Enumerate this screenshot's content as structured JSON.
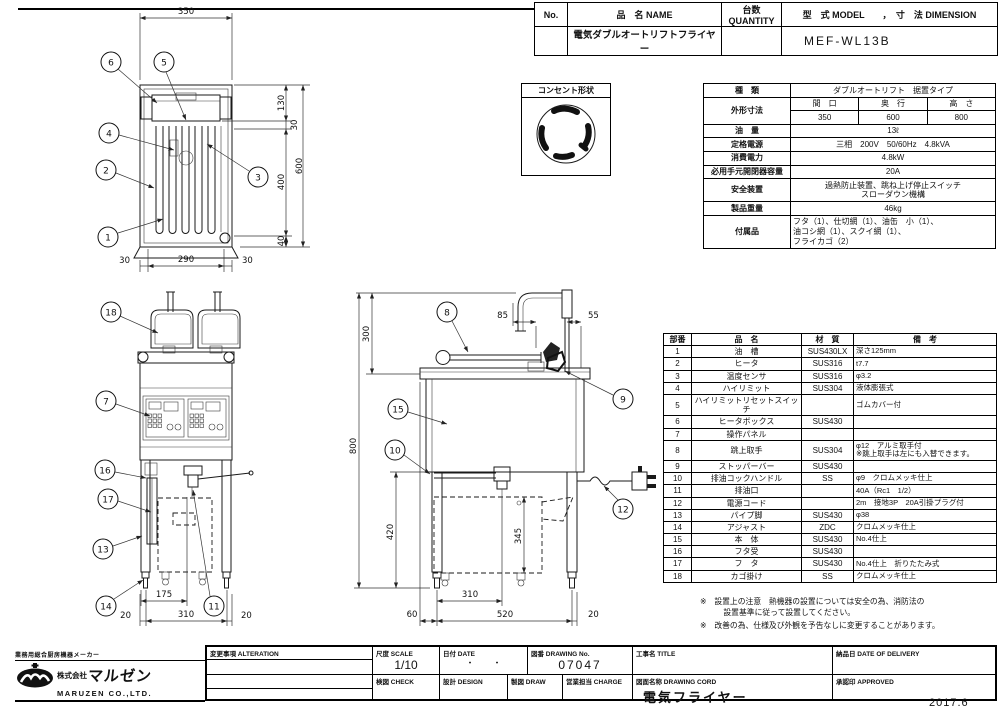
{
  "header": {
    "no_label": "No.",
    "name_label": "品　名 NAME",
    "qty_label": "台数 QUANTITY",
    "model_dim_label": "型　式 MODEL　　，　寸　法 DIMENSION",
    "product_name": "電気ダブルオートリフトフライヤー",
    "model_value": "MEF-WL13B"
  },
  "outlet": {
    "label": "コンセント形状"
  },
  "spec": {
    "kind_label": "種　類",
    "kind_value": "ダブルオートリフト　据置タイプ",
    "outer_dims_label": "外形寸法",
    "dim_cols": [
      {
        "h": "間　口",
        "v": "350"
      },
      {
        "h": "奥　行",
        "v": "600"
      },
      {
        "h": "高　さ",
        "v": "800"
      }
    ],
    "oil_label": "油　量",
    "oil_value": "13ℓ",
    "power_label": "定格電源",
    "power_value": "三相　200V　50/60Hz　4.8kVA",
    "consumption_label": "消費電力",
    "consumption_value": "4.8kW",
    "breaker_label": "必用手元開閉器容量",
    "breaker_value": "20A",
    "safety_label": "安全装置",
    "safety_value": "過熱防止装置、跳ね上げ停止スイッチ\nスローダウン機構",
    "weight_label": "製品重量",
    "weight_value": "46kg",
    "accessories_label": "付属品",
    "accessories_value": "フタ（1）、仕切網（1）、油缶　小（1）、\n油コシ網（1）、スクイ網（1）、\nフライカゴ（2）"
  },
  "parts": {
    "headers": [
      "部番",
      "品　名",
      "材　質",
      "備　考"
    ],
    "rows": [
      {
        "no": "1",
        "name": "油　槽",
        "material": "SUS430LX",
        "note": "深さ125mm"
      },
      {
        "no": "2",
        "name": "ヒータ",
        "material": "SUS316",
        "note": "t7.7"
      },
      {
        "no": "3",
        "name": "温度センサ",
        "material": "SUS316",
        "note": "φ3.2"
      },
      {
        "no": "4",
        "name": "ハイリミット",
        "material": "SUS304",
        "note": "液体膨張式"
      },
      {
        "no": "5",
        "name": "ハイリミットリセットスイッチ",
        "material": "",
        "note": "ゴムカバー付"
      },
      {
        "no": "6",
        "name": "ヒータボックス",
        "material": "SUS430",
        "note": ""
      },
      {
        "no": "7",
        "name": "操作パネル",
        "material": "",
        "note": ""
      },
      {
        "no": "8",
        "name": "跳上取手",
        "material": "SUS304",
        "note": "φ12　アルミ取手付\n※跳上取手は左にも入替できます。"
      },
      {
        "no": "9",
        "name": "ストッパーバー",
        "material": "SUS430",
        "note": ""
      },
      {
        "no": "10",
        "name": "排油コックハンドル",
        "material": "SS",
        "note": "φ9　クロムメッキ仕上"
      },
      {
        "no": "11",
        "name": "排油口",
        "material": "",
        "note": "40A（Rc1　1/2）"
      },
      {
        "no": "12",
        "name": "電源コード",
        "material": "",
        "note": "2m　接地3P　20A引掛プラグ付"
      },
      {
        "no": "13",
        "name": "パイプ脚",
        "material": "SUS430",
        "note": "φ38"
      },
      {
        "no": "14",
        "name": "アジャスト",
        "material": "ZDC",
        "note": "クロムメッキ仕上"
      },
      {
        "no": "15",
        "name": "本　体",
        "material": "SUS430",
        "note": "No.4仕上"
      },
      {
        "no": "16",
        "name": "フタ受",
        "material": "SUS430",
        "note": ""
      },
      {
        "no": "17",
        "name": "フ　タ",
        "material": "SUS430",
        "note": "No.4仕上　折りたたみ式"
      },
      {
        "no": "18",
        "name": "カゴ掛け",
        "material": "SS",
        "note": "クロムメッキ仕上"
      }
    ]
  },
  "notes": {
    "note1": "※　設置上の注意　熱機器の設置については安全の為、消防法の\n　　　設置基準に従って設置してください。",
    "note2": "※　改善の為、仕様及び外観を予告なしに変更することがあります。"
  },
  "title_block": {
    "alteration": "変更事項  ALTERATION",
    "scale_label": "尺度  SCALE",
    "scale_value": "1/10",
    "date_label": "日付  DATE",
    "date_value": "・　　・",
    "dwg_no_label": "図番  DRAWING No.",
    "dwg_no_value": "07047",
    "title_label": "工事名  TITLE",
    "delivery_label": "納品日  DATE OF DELIVERY",
    "check_label": "検図  CHECK",
    "design_label": "設計  DESIGN",
    "draw_label": "製図  DRAW",
    "charge_label": "営業担当  CHARGE",
    "dwg_name_label": "図面名称  DRAWING CORD",
    "dwg_name_value": "電気フライヤー",
    "approved_label": "承認印  APPROVED"
  },
  "logo": {
    "tagline": "業務用総合厨房機器メーカー",
    "company_prefix": "株式会社",
    "company_name": "マルゼン",
    "company_en": "MARUZEN  CO.,LTD."
  },
  "issue_date": "2017.6",
  "drawings": {
    "plan": {
      "dim_width": "350",
      "seg_130": "130",
      "seg_30t": "30",
      "seg_400": "400",
      "seg_40": "40",
      "dim_total": "600",
      "bottom": [
        "30",
        "290",
        "30"
      ],
      "callouts": [
        "6",
        "5",
        "4",
        "2",
        "3",
        "1"
      ]
    },
    "front": {
      "dim_175": "175",
      "bottom": [
        "20",
        "310",
        "20"
      ],
      "callouts": [
        "18",
        "7",
        "16",
        "17",
        "13",
        "14",
        "11"
      ]
    },
    "side": {
      "dim_300": "300",
      "dim_85": "85",
      "dim_55": "55",
      "dim_800": "800",
      "dim_420": "420",
      "dim_345": "345",
      "dim_310": "310",
      "bottom": [
        "60",
        "520",
        "20"
      ],
      "callouts": [
        "8",
        "9",
        "15",
        "10",
        "12"
      ]
    }
  }
}
